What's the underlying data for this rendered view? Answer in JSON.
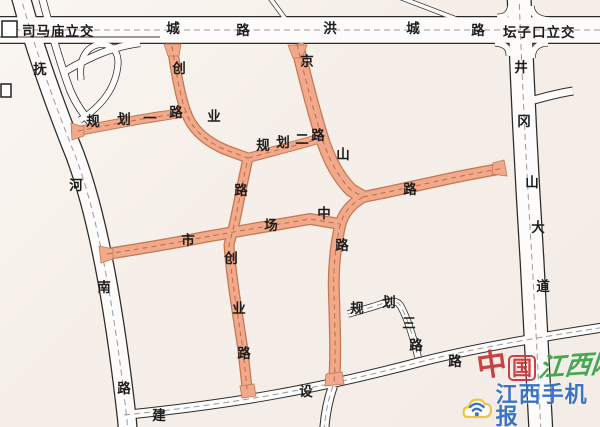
{
  "map": {
    "description": "City road map with highlighted (orange) roads",
    "colors": {
      "background": "#f6efe9",
      "road_fill": "#fdfcfa",
      "road_casing": "#2a2a2a",
      "highlight_fill": "#f2a98b",
      "highlight_casing": "#c1784f",
      "label_text": "#1c1c1c"
    },
    "interchanges": [
      {
        "id": "simamiao-interchange",
        "label": "司马庙立交"
      },
      {
        "id": "tanzikou-interchange",
        "label": "坛子口立交"
      }
    ],
    "roads": [
      {
        "id": "hongcheng-road",
        "name": "洪城路",
        "highlighted": false,
        "label_chars": [
          {
            "ch": "城",
            "x": 173,
            "y": 29
          },
          {
            "ch": "路",
            "x": 243,
            "y": 31
          },
          {
            "ch": "洪",
            "x": 330,
            "y": 29
          },
          {
            "ch": "城",
            "x": 413,
            "y": 29
          },
          {
            "ch": "路",
            "x": 478,
            "y": 31
          }
        ]
      },
      {
        "id": "fuhe-south-road",
        "name": "抚河南路",
        "highlighted": false,
        "label_chars": [
          {
            "ch": "抚",
            "x": 40,
            "y": 70
          },
          {
            "ch": "河",
            "x": 76,
            "y": 186
          },
          {
            "ch": "南",
            "x": 104,
            "y": 288
          },
          {
            "ch": "路",
            "x": 124,
            "y": 389
          }
        ]
      },
      {
        "id": "jinggangshan-avenue",
        "name": "井冈山大道",
        "highlighted": false,
        "label_chars": [
          {
            "ch": "井",
            "x": 521,
            "y": 68
          },
          {
            "ch": "冈",
            "x": 524,
            "y": 122
          },
          {
            "ch": "山",
            "x": 532,
            "y": 183
          },
          {
            "ch": "大",
            "x": 538,
            "y": 228
          },
          {
            "ch": "道",
            "x": 543,
            "y": 287
          }
        ]
      },
      {
        "id": "jianshe-road",
        "name": "建设路",
        "highlighted": false,
        "label_chars": [
          {
            "ch": "建",
            "x": 159,
            "y": 416
          },
          {
            "ch": "设",
            "x": 306,
            "y": 392
          },
          {
            "ch": "路",
            "x": 455,
            "y": 362
          }
        ]
      },
      {
        "id": "jingshan-road",
        "name": "京山路",
        "highlighted": true,
        "label_chars": [
          {
            "ch": "京",
            "x": 307,
            "y": 62
          },
          {
            "ch": "山",
            "x": 343,
            "y": 155
          },
          {
            "ch": "路",
            "x": 410,
            "y": 190
          }
        ]
      },
      {
        "id": "shichang-middle-road",
        "name": "市场中路",
        "highlighted": true,
        "label_chars": [
          {
            "ch": "市",
            "x": 188,
            "y": 241
          },
          {
            "ch": "场",
            "x": 271,
            "y": 226
          },
          {
            "ch": "中",
            "x": 324,
            "y": 214
          },
          {
            "ch": "路",
            "x": 342,
            "y": 246
          }
        ]
      },
      {
        "id": "chuangye-road",
        "name": "创业路",
        "highlighted": true,
        "label_chars": [
          {
            "ch": "创",
            "x": 179,
            "y": 69
          },
          {
            "ch": "业",
            "x": 214,
            "y": 117
          },
          {
            "ch": "路",
            "x": 241,
            "y": 191
          },
          {
            "ch": "创",
            "x": 231,
            "y": 259
          },
          {
            "ch": "业",
            "x": 239,
            "y": 309
          },
          {
            "ch": "路",
            "x": 244,
            "y": 354
          }
        ]
      },
      {
        "id": "guihua-no1-road",
        "name": "规划一路",
        "highlighted": true,
        "label_chars": [
          {
            "ch": "规",
            "x": 93,
            "y": 122
          },
          {
            "ch": "划",
            "x": 124,
            "y": 120
          },
          {
            "ch": "一",
            "x": 150,
            "y": 119
          },
          {
            "ch": "路",
            "x": 176,
            "y": 113
          }
        ]
      },
      {
        "id": "guihua-no2-road",
        "name": "规划二路",
        "highlighted": true,
        "label_chars": [
          {
            "ch": "规",
            "x": 263,
            "y": 146
          },
          {
            "ch": "划",
            "x": 283,
            "y": 143
          },
          {
            "ch": "二",
            "x": 302,
            "y": 140
          },
          {
            "ch": "路",
            "x": 318,
            "y": 136
          }
        ]
      },
      {
        "id": "guihua-no3-road",
        "name": "规划三路",
        "highlighted": false,
        "label_chars": [
          {
            "ch": "规",
            "x": 357,
            "y": 309
          },
          {
            "ch": "划",
            "x": 389,
            "y": 303
          },
          {
            "ch": "三",
            "x": 409,
            "y": 324
          },
          {
            "ch": "路",
            "x": 416,
            "y": 346
          }
        ]
      }
    ]
  },
  "watermark": {
    "site_char1": "中",
    "site_char2": "国",
    "site_rest": "江西网",
    "app_name": "江西手机报",
    "colors": {
      "red": "#c5393b",
      "green": "#3ca64b",
      "blue": "#2f6ec5",
      "yellow": "#f0c04a"
    }
  }
}
